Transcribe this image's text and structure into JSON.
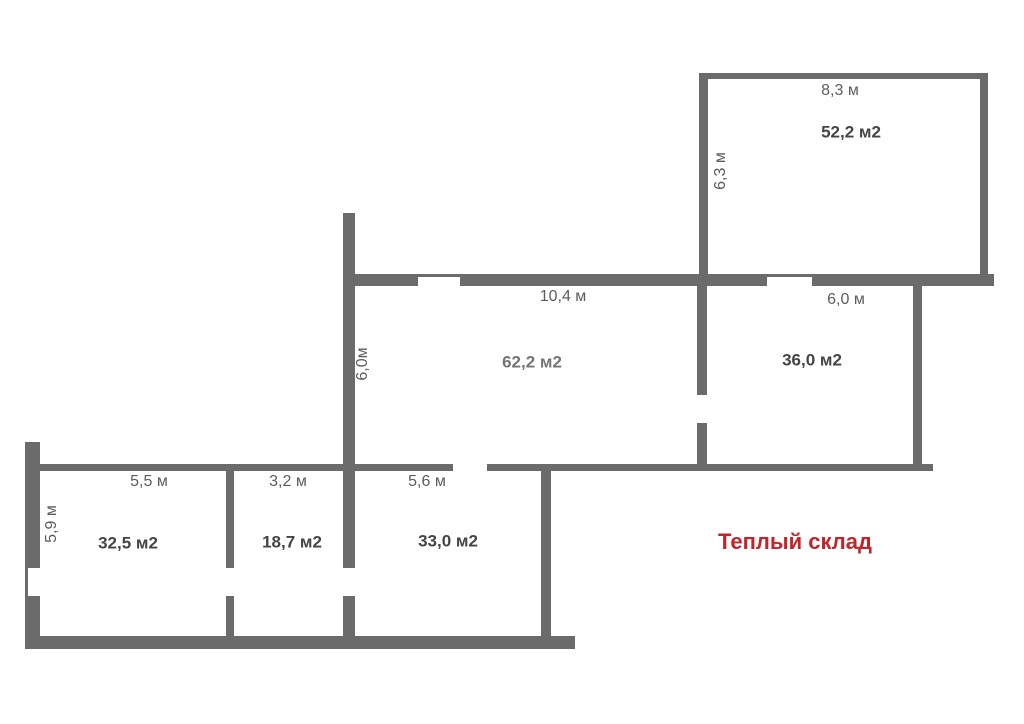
{
  "colors": {
    "wall": "#6b6b6b",
    "dimension_text": "#5c5c5c",
    "area_text": "#454545",
    "faded_area_text": "#757575",
    "title_red": "#c3242c",
    "background": "#ffffff"
  },
  "warehouse": {
    "text": "Теплый склад",
    "x": 795,
    "y": 542
  },
  "rooms": [
    {
      "id": "room-52-2",
      "area": {
        "text": "52,2 м2",
        "x": 851,
        "y": 132,
        "faded": false
      },
      "dims": [
        {
          "text": "8,3 м",
          "x": 840,
          "y": 91,
          "rotated": false
        },
        {
          "text": "6,3 м",
          "x": 721,
          "y": 171,
          "rotated": true
        }
      ]
    },
    {
      "id": "room-62-2",
      "area": {
        "text": "62,2 м2",
        "x": 532,
        "y": 362,
        "faded": true
      },
      "dims": [
        {
          "text": "10,4 м",
          "x": 563,
          "y": 297,
          "rotated": false
        },
        {
          "text": "6,0м",
          "x": 363,
          "y": 364,
          "rotated": true
        }
      ]
    },
    {
      "id": "room-36-0",
      "area": {
        "text": "36,0 м2",
        "x": 812,
        "y": 360,
        "faded": false
      },
      "dims": [
        {
          "text": "6,0 м",
          "x": 846,
          "y": 300,
          "rotated": false
        }
      ]
    },
    {
      "id": "room-32-5",
      "area": {
        "text": "32,5 м2",
        "x": 128,
        "y": 543,
        "faded": false
      },
      "dims": [
        {
          "text": "5,5 м",
          "x": 149,
          "y": 482,
          "rotated": false
        },
        {
          "text": "5,9 м",
          "x": 52,
          "y": 524,
          "rotated": true
        }
      ]
    },
    {
      "id": "room-18-7",
      "area": {
        "text": "18,7 м2",
        "x": 292,
        "y": 542,
        "faded": false
      },
      "dims": [
        {
          "text": "3,2 м",
          "x": 288,
          "y": 482,
          "rotated": false
        }
      ]
    },
    {
      "id": "room-33-0",
      "area": {
        "text": "33,0 м2",
        "x": 448,
        "y": 541,
        "faded": false
      },
      "dims": [
        {
          "text": "5,6 м",
          "x": 427,
          "y": 482,
          "rotated": false
        }
      ]
    }
  ],
  "walls": [
    {
      "x": 699,
      "y": 73,
      "w": 289,
      "h": 6
    },
    {
      "x": 699,
      "y": 73,
      "w": 9,
      "h": 201
    },
    {
      "x": 980,
      "y": 73,
      "w": 8,
      "h": 213
    },
    {
      "x": 343,
      "y": 274,
      "w": 75,
      "h": 12
    },
    {
      "x": 460,
      "y": 274,
      "w": 307,
      "h": 12
    },
    {
      "x": 812,
      "y": 274,
      "w": 182,
      "h": 12
    },
    {
      "x": 418,
      "y": 274,
      "w": 42,
      "h": 3
    },
    {
      "x": 767,
      "y": 274,
      "w": 45,
      "h": 3
    },
    {
      "x": 343,
      "y": 213,
      "w": 12,
      "h": 355
    },
    {
      "x": 343,
      "y": 596,
      "w": 12,
      "h": 48
    },
    {
      "x": 697,
      "y": 286,
      "w": 10,
      "h": 109
    },
    {
      "x": 697,
      "y": 423,
      "w": 10,
      "h": 41
    },
    {
      "x": 913,
      "y": 286,
      "w": 9,
      "h": 185
    },
    {
      "x": 27,
      "y": 464,
      "w": 426,
      "h": 7
    },
    {
      "x": 487,
      "y": 464,
      "w": 446,
      "h": 7
    },
    {
      "x": 25,
      "y": 442,
      "w": 15,
      "h": 126
    },
    {
      "x": 25,
      "y": 568,
      "w": 3,
      "h": 28
    },
    {
      "x": 25,
      "y": 596,
      "w": 15,
      "h": 47
    },
    {
      "x": 226,
      "y": 471,
      "w": 8,
      "h": 97
    },
    {
      "x": 226,
      "y": 596,
      "w": 8,
      "h": 45
    },
    {
      "x": 541,
      "y": 471,
      "w": 10,
      "h": 170
    },
    {
      "x": 25,
      "y": 636,
      "w": 550,
      "h": 13
    }
  ]
}
